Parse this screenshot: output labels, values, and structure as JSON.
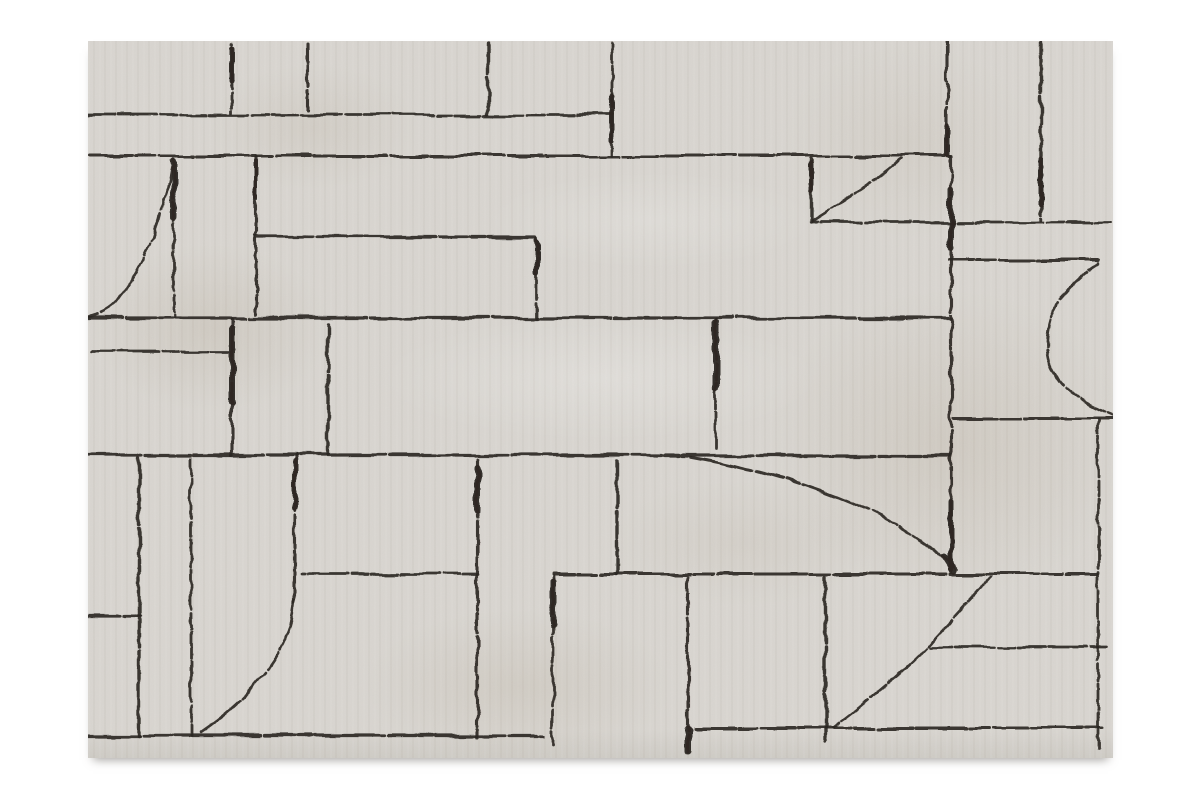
{
  "scene": {
    "subject": "beige area rug with abstract charcoal line pattern, product photo on white background",
    "background_color": "#ffffff"
  },
  "rug": {
    "x": 88,
    "y": 41,
    "width": 1025,
    "height": 717,
    "base_color": "#d9d6d1",
    "edge_color": "#cfccc6",
    "line_color": "#2d2822",
    "viewbox": "0 0 1025 717",
    "horizontal_lines": [
      {
        "y": 74,
        "x1": 0,
        "x2": 525
      },
      {
        "y": 115,
        "x1": 0,
        "x2": 862
      },
      {
        "y": 196,
        "x1": 169,
        "x2": 448
      },
      {
        "y": 181,
        "x1": 724,
        "x2": 1022
      },
      {
        "y": 219,
        "x1": 861,
        "x2": 1012
      },
      {
        "y": 277,
        "x1": 0,
        "x2": 862
      },
      {
        "y": 311,
        "x1": 3,
        "x2": 140
      },
      {
        "y": 377,
        "x1": 867,
        "x2": 1024
      },
      {
        "y": 414,
        "x1": 0,
        "x2": 862
      },
      {
        "y": 533,
        "x1": 214,
        "x2": 390
      },
      {
        "y": 533,
        "x1": 465,
        "x2": 1009
      },
      {
        "y": 575,
        "x1": 0,
        "x2": 52
      },
      {
        "y": 606,
        "x1": 842,
        "x2": 1022
      },
      {
        "y": 687,
        "x1": 606,
        "x2": 1014
      },
      {
        "y": 695,
        "x1": 0,
        "x2": 456
      }
    ],
    "vertical_lines": [
      {
        "x": 144,
        "y1": 3,
        "y2": 72
      },
      {
        "x": 220,
        "y1": 3,
        "y2": 69
      },
      {
        "x": 400,
        "y1": 2,
        "y2": 72
      },
      {
        "x": 524,
        "y1": 2,
        "y2": 114
      },
      {
        "x": 859,
        "y1": 1,
        "y2": 114
      },
      {
        "x": 953,
        "y1": 1,
        "y2": 179
      },
      {
        "x": 86,
        "y1": 116,
        "y2": 276
      },
      {
        "x": 168,
        "y1": 116,
        "y2": 277
      },
      {
        "x": 723,
        "y1": 118,
        "y2": 181
      },
      {
        "x": 449,
        "y1": 197,
        "y2": 277
      },
      {
        "x": 144,
        "y1": 278,
        "y2": 414
      },
      {
        "x": 240,
        "y1": 283,
        "y2": 413
      },
      {
        "x": 628,
        "y1": 278,
        "y2": 407
      },
      {
        "x": 863,
        "y1": 115,
        "y2": 531
      },
      {
        "x": 51,
        "y1": 417,
        "y2": 695
      },
      {
        "x": 103,
        "y1": 418,
        "y2": 695
      },
      {
        "x": 389,
        "y1": 418,
        "y2": 697
      },
      {
        "x": 529,
        "y1": 420,
        "y2": 533
      },
      {
        "x": 465,
        "y1": 535,
        "y2": 704
      },
      {
        "x": 600,
        "y1": 536,
        "y2": 711
      },
      {
        "x": 737,
        "y1": 536,
        "y2": 701
      },
      {
        "x": 1010,
        "y1": 378,
        "y2": 709
      },
      {
        "x": 207,
        "y1": 414,
        "y2": 562
      }
    ],
    "curves": [
      {
        "name": "top-left-arc",
        "d": "M 84 126 C 78 165 62 218 28 262 C 18 272 6 275 0 276"
      },
      {
        "name": "right-upper-swoop",
        "d": "M 813 118 C 792 137 752 162 724 180"
      },
      {
        "name": "bottom-left-arc",
        "d": "M 207 560 C 204 602 176 648 112 692"
      },
      {
        "name": "center-long-arc",
        "d": "M 603 416 C 692 432 802 464 869 528"
      },
      {
        "name": "right-c-arc",
        "d": "M 1012 222 C 984 240 961 262 959 299 C 957 331 976 355 1024 374"
      },
      {
        "name": "bottom-right-swoop",
        "d": "M 902 536 C 888 553 861 581 844 600 C 825 623 779 661 744 687"
      }
    ],
    "thick_spots": [
      {
        "x1": 144,
        "y1": 8,
        "x2": 144,
        "y2": 40,
        "w": 5
      },
      {
        "x1": 524,
        "y1": 55,
        "x2": 524,
        "y2": 100,
        "w": 5
      },
      {
        "x1": 859,
        "y1": 86,
        "x2": 859,
        "y2": 113,
        "w": 6
      },
      {
        "x1": 953,
        "y1": 118,
        "x2": 953,
        "y2": 165,
        "w": 5
      },
      {
        "x1": 86,
        "y1": 120,
        "x2": 86,
        "y2": 175,
        "w": 6
      },
      {
        "x1": 168,
        "y1": 120,
        "x2": 168,
        "y2": 158,
        "w": 4
      },
      {
        "x1": 723,
        "y1": 122,
        "x2": 723,
        "y2": 150,
        "w": 5
      },
      {
        "x1": 449,
        "y1": 200,
        "x2": 449,
        "y2": 232,
        "w": 5
      },
      {
        "x1": 863,
        "y1": 148,
        "x2": 863,
        "y2": 206,
        "w": 6
      },
      {
        "x1": 144,
        "y1": 288,
        "x2": 144,
        "y2": 362,
        "w": 6
      },
      {
        "x1": 628,
        "y1": 282,
        "x2": 628,
        "y2": 346,
        "w": 7
      },
      {
        "x1": 863,
        "y1": 462,
        "x2": 863,
        "y2": 528,
        "w": 5
      },
      {
        "x1": 207,
        "y1": 420,
        "x2": 207,
        "y2": 468,
        "w": 5
      },
      {
        "x1": 389,
        "y1": 426,
        "x2": 389,
        "y2": 470,
        "w": 6
      },
      {
        "x1": 465,
        "y1": 540,
        "x2": 465,
        "y2": 584,
        "w": 6
      },
      {
        "x1": 600,
        "y1": 688,
        "x2": 600,
        "y2": 710,
        "w": 7
      },
      {
        "x1": 857,
        "y1": 516,
        "x2": 866,
        "y2": 530,
        "w": 6
      }
    ]
  }
}
